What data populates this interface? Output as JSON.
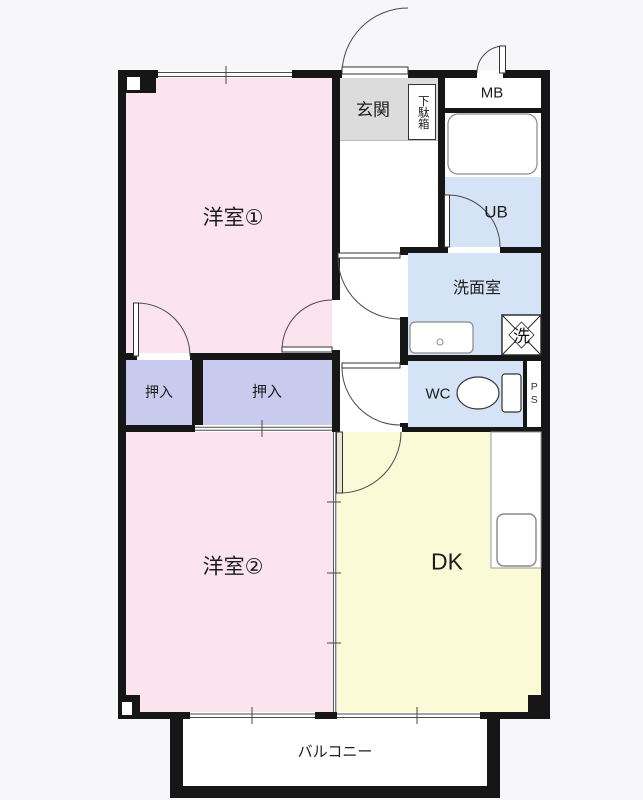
{
  "floorplan": {
    "type": "apartment-floor-plan",
    "rooms": {
      "western1": {
        "label": "洋室①"
      },
      "western2": {
        "label": "洋室②"
      },
      "closet_left": {
        "label": "押入"
      },
      "closet_right": {
        "label": "押入"
      },
      "entrance": {
        "label": "玄関"
      },
      "shoe_cabinet": {
        "label": "下駄箱"
      },
      "meter_box": {
        "label": "MB"
      },
      "unit_bath": {
        "label": "UB"
      },
      "washroom": {
        "label": "洗面室"
      },
      "wc": {
        "label": "WC"
      },
      "pipe_space": {
        "label": "PS"
      },
      "dining_kitchen": {
        "label": "DK"
      },
      "balcony": {
        "label": "バルコニー"
      }
    },
    "fixtures": {
      "washing_machine": {
        "label": "洗"
      },
      "bathtub": {
        "label": ""
      },
      "toilet": {
        "label": ""
      },
      "washbasin": {
        "label": ""
      },
      "kitchen_sink": {
        "label": ""
      }
    },
    "colors": {
      "wall": "#161616",
      "room_pink": "#fce4ef",
      "closet_lavender": "#c9cbee",
      "water_blue": "#d4e3f5",
      "dk_yellow": "#fbfad7",
      "entrance_gray": "#dcdcdc",
      "background": "#f7f7f9"
    }
  }
}
